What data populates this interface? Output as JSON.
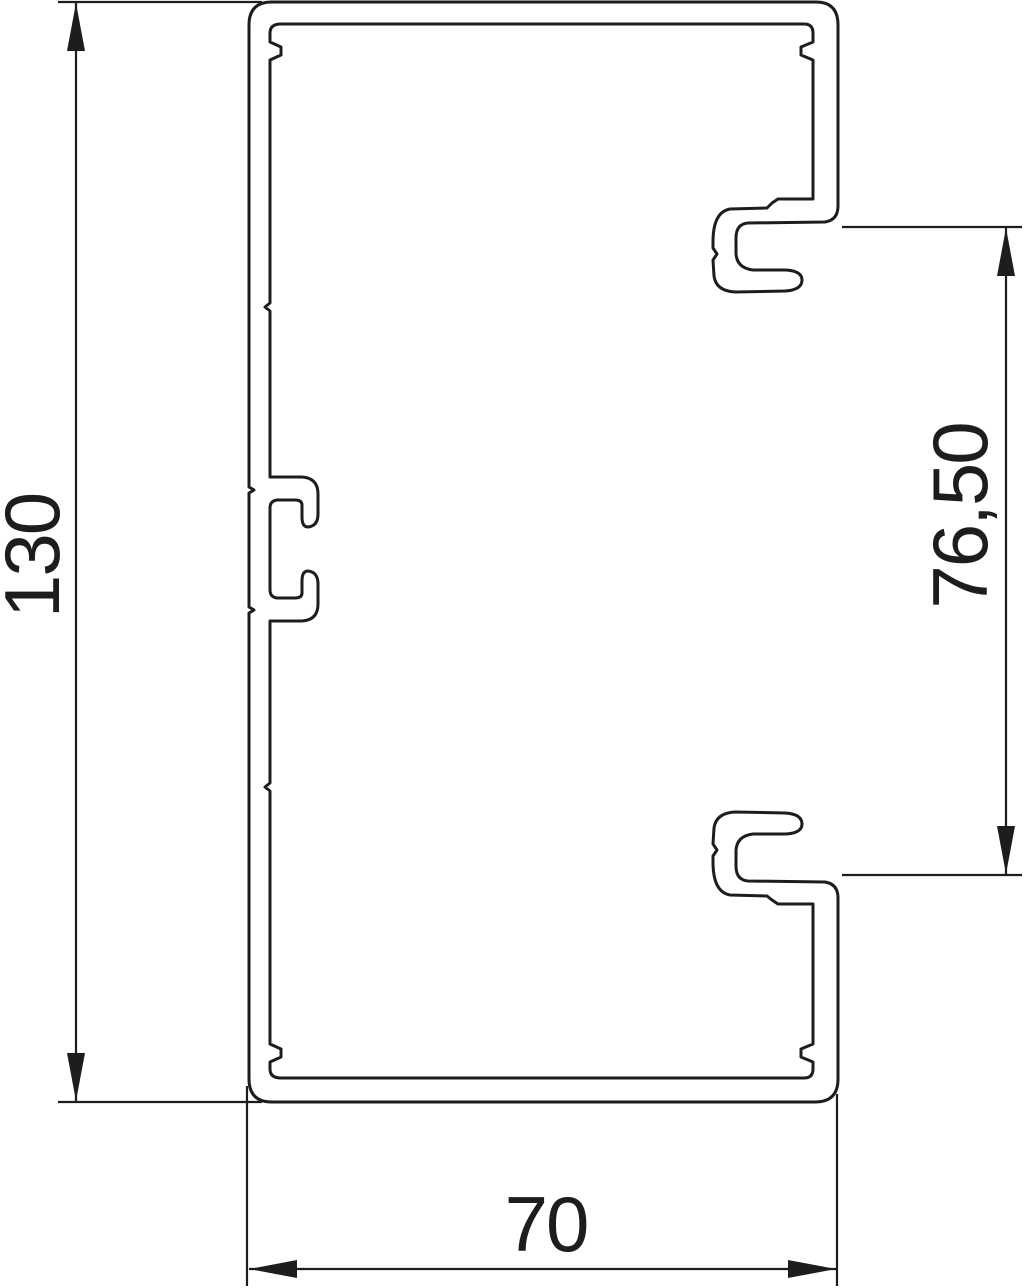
{
  "drawing": {
    "background_color": "#ffffff",
    "line_color": "#1d1d1b",
    "subject": "cable-trunking-profile-cross-section"
  },
  "dimensions": {
    "height_label": "130",
    "opening_label": "76,50",
    "width_label": "70"
  }
}
